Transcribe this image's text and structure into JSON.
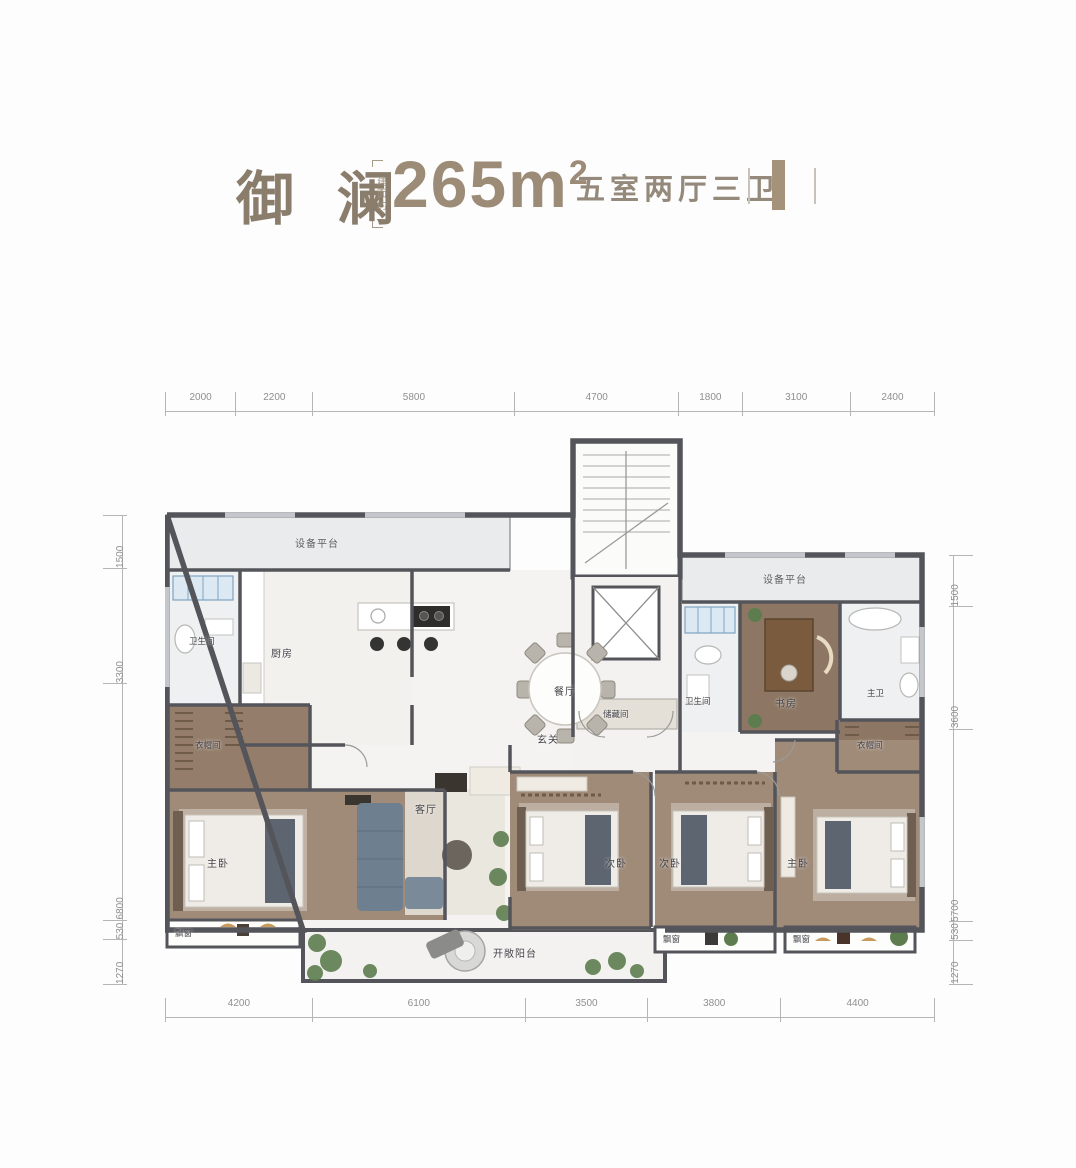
{
  "header": {
    "name": "御 澜",
    "area_label": "建面约",
    "area_value": "265m",
    "area_sup": "2",
    "spec": "五室两厅三卫"
  },
  "dimensions": {
    "top": [
      "2000",
      "2200",
      "5800",
      "4700",
      "1800",
      "3100",
      "2400"
    ],
    "bottom": [
      "4200",
      "6100",
      "3500",
      "3800",
      "4400"
    ],
    "left": [
      "1500",
      "3300",
      "6800",
      "530",
      "1270"
    ],
    "right": [
      "1500",
      "3600",
      "5700",
      "530",
      "1270"
    ]
  },
  "rooms": {
    "equip_left": "设备平台",
    "equip_right": "设备平台",
    "bath_left": "卫生间",
    "kitchen": "厨房",
    "dining": "餐厅",
    "cloak_left": "衣帽间",
    "master_left": "主卧",
    "bay_left": "飘窗",
    "living": "客厅",
    "entry": "玄关",
    "storage": "储藏间",
    "bath_mid": "卫生间",
    "study": "书房",
    "master_bath": "主卫",
    "cloak_right": "衣帽间",
    "bedroom2": "次卧",
    "bedroom3": "次卧",
    "bay_mid": "飘窗",
    "master_right": "主卧",
    "bay_right": "飘窗",
    "balcony": "开敞阳台"
  },
  "colors": {
    "accent": "#9c8b76",
    "wall": "#54555a",
    "wood": "#9f8a77",
    "marble": "#f4f3f1"
  }
}
